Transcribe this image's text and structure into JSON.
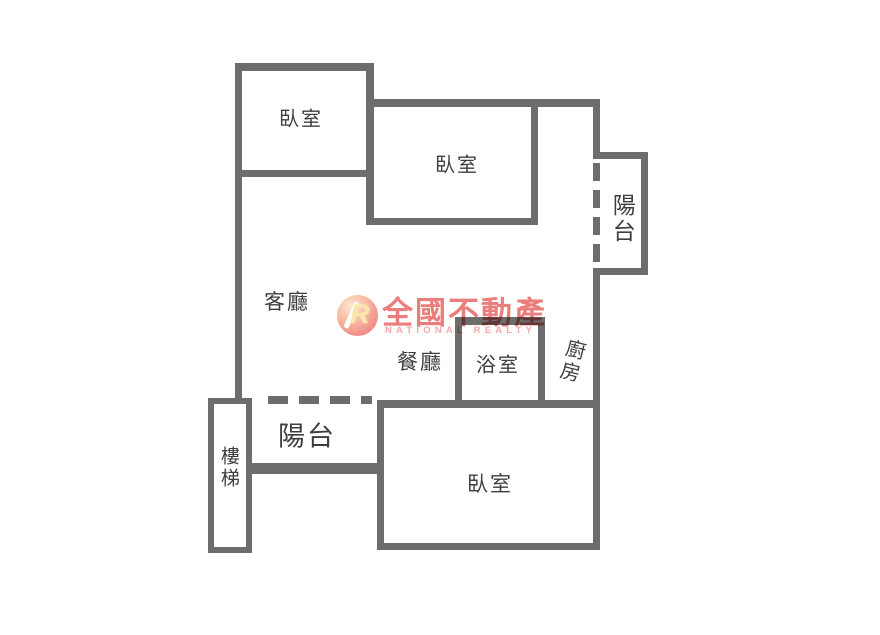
{
  "floorplan": {
    "rooms": {
      "bedroom_top_left": {
        "label": "臥室"
      },
      "bedroom_top_right": {
        "label": "臥室"
      },
      "balcony_right": {
        "label": "陽台"
      },
      "living_room": {
        "label": "客廳"
      },
      "dining_room": {
        "label": "餐廳"
      },
      "bathroom": {
        "label": "浴室"
      },
      "kitchen": {
        "label": "廚房"
      },
      "balcony_bottom": {
        "label": "陽台"
      },
      "stairs": {
        "label": "樓梯"
      },
      "bedroom_bottom": {
        "label": "臥室"
      }
    },
    "colors": {
      "wall": "#6d6d6d",
      "label": "#3e3e3e",
      "background": "#ffffff"
    }
  },
  "watermark": {
    "brand": "全國不動產",
    "subtitle": "NATIONAL REALTY",
    "logo_letter": "R",
    "colors": {
      "brand_red": "#eb7d7d",
      "subtitle_pink": "#f3a9a9",
      "logo_circle": "#f1908a"
    }
  }
}
